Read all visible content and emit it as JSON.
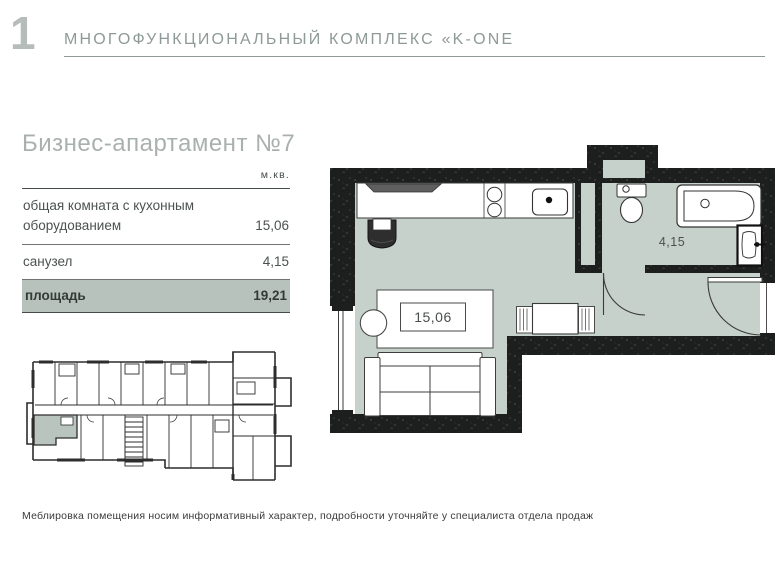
{
  "page": {
    "number": "1",
    "title": "МНОГОФУНКЦИОНАЛЬНЫЙ КОМПЛЕКС «K-ONE",
    "disclaimer": "Меблировка помещения носим информативный характер, подробности уточняйте у специалиста отдела продаж"
  },
  "apartment": {
    "heading": "Бизнес-апартамент №7",
    "table": {
      "unit_header": "м.кв.",
      "rows": [
        {
          "label": "общая комната с кухонным оборудованием",
          "value": "15,06"
        },
        {
          "label": "санузел",
          "value": "4,15"
        },
        {
          "label": "площадь",
          "value": "19,21"
        }
      ]
    }
  },
  "floorplan": {
    "labels": {
      "living_area": "15,06",
      "bathroom_area": "4,15"
    }
  },
  "colors": {
    "floor_sage": "#c7d1cb",
    "highlight_row": "#b7c2bc",
    "wall": "#1d1f1e",
    "muted_text": "#8e9a97",
    "heading_text": "#a9b1ae"
  }
}
